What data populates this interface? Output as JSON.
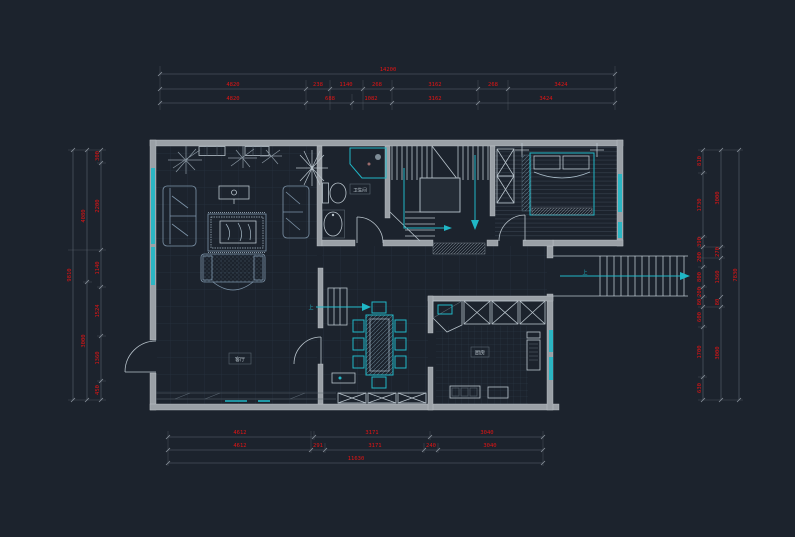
{
  "drawing": {
    "type": "cad-floor-plan",
    "style": "autocad-dark"
  },
  "colors": {
    "background": "#1c232d",
    "wall": "#9aa0a6",
    "dimension_text": "#e31414",
    "accent_teal": "#1fb7c6",
    "furniture_line": "#7e95aa",
    "grid_line": "#26323f"
  },
  "labels": {
    "living_room": "客厅",
    "bathroom": "卫生间",
    "kitchen": "厨房",
    "stair_up_hall": "上",
    "stair_up_entry": "上"
  },
  "dimensions": {
    "top": {
      "overall": "14200",
      "row1": [
        "4820",
        "238",
        "1140",
        "268",
        "3162",
        "268",
        "3424"
      ],
      "row2": [
        "4820",
        "688",
        "1082",
        "3162",
        "3424"
      ]
    },
    "bottom": {
      "row1": [
        "4612",
        "3171",
        "3040"
      ],
      "row2": [
        "4612",
        "291",
        "3171",
        "240",
        "3040"
      ],
      "overall": "11630"
    },
    "left": {
      "overall": "9810",
      "middle": [
        "4080",
        "3000"
      ],
      "inner": [
        "300",
        "2200",
        "1140",
        "1524",
        "1360",
        "450"
      ]
    },
    "right": {
      "overall": "7830",
      "middle": [
        "3000",
        "270",
        "1360",
        "80",
        "3000"
      ],
      "inner": [
        "810",
        "1730",
        "390",
        "200",
        "800",
        "200",
        "80",
        "600",
        "1700",
        "630"
      ]
    }
  }
}
